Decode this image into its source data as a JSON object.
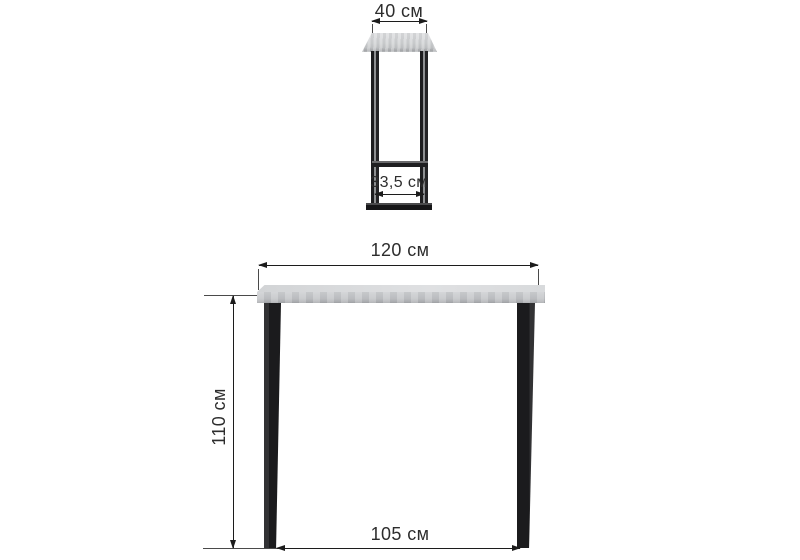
{
  "diagram": {
    "type": "furniture-dimension-drawing",
    "measurements": {
      "top_width": "40 см",
      "depth": "33,5 см",
      "width": "120 см",
      "height": "110 см",
      "leg_span": "105 см"
    },
    "colors": {
      "background": "#ffffff",
      "dimension_line": "#1c1c1c",
      "text": "#2d2d2d",
      "tabletop_light": "#dfe0e2",
      "tabletop_shade": "#a9abae",
      "frame_black": "#1d1d1f"
    }
  }
}
